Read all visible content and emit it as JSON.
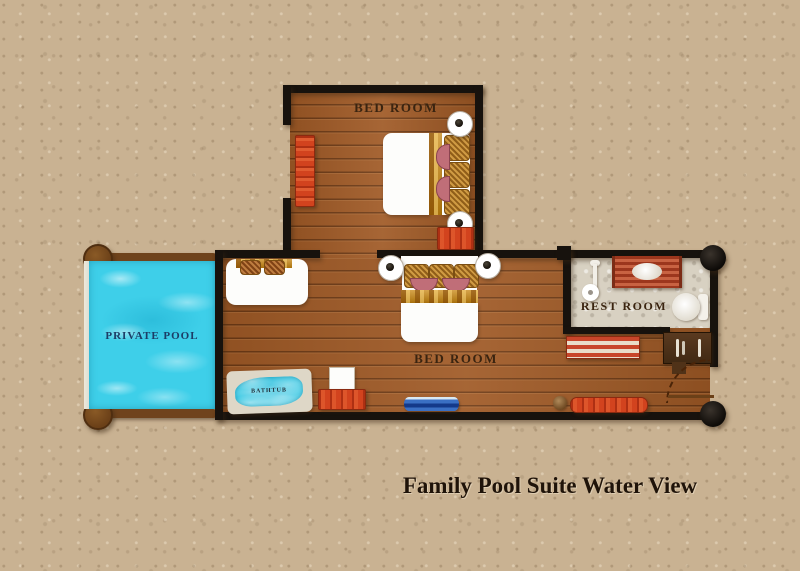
{
  "title": "Family Pool Suite Water View",
  "rooms": {
    "bedroom_top": {
      "label": "BED ROOM"
    },
    "bedroom_main": {
      "label": "BED ROOM"
    },
    "restroom": {
      "label": "REST ROOM"
    },
    "private_pool": {
      "label": "PRIVATE POOL"
    },
    "bathtub": {
      "label": "BATHTUB"
    }
  },
  "colors": {
    "background_sand": "#c9b292",
    "wood_floor": "#a05a26",
    "wall_black": "#17120d",
    "pool_water": "#3ecfe9",
    "pool_label_text": "#1c3d66",
    "room_label_text": "#3a2410",
    "restroom_floor": "#d8d1c2",
    "furniture_red": "#d2431e",
    "blanket_gold": "#c8860f",
    "title_text": "#1f1309"
  },
  "icons": {
    "pool_posts": "wooden-post-icon",
    "wall_posts": "black-post-icon",
    "door_swing": "door-swing-arc-icon"
  }
}
